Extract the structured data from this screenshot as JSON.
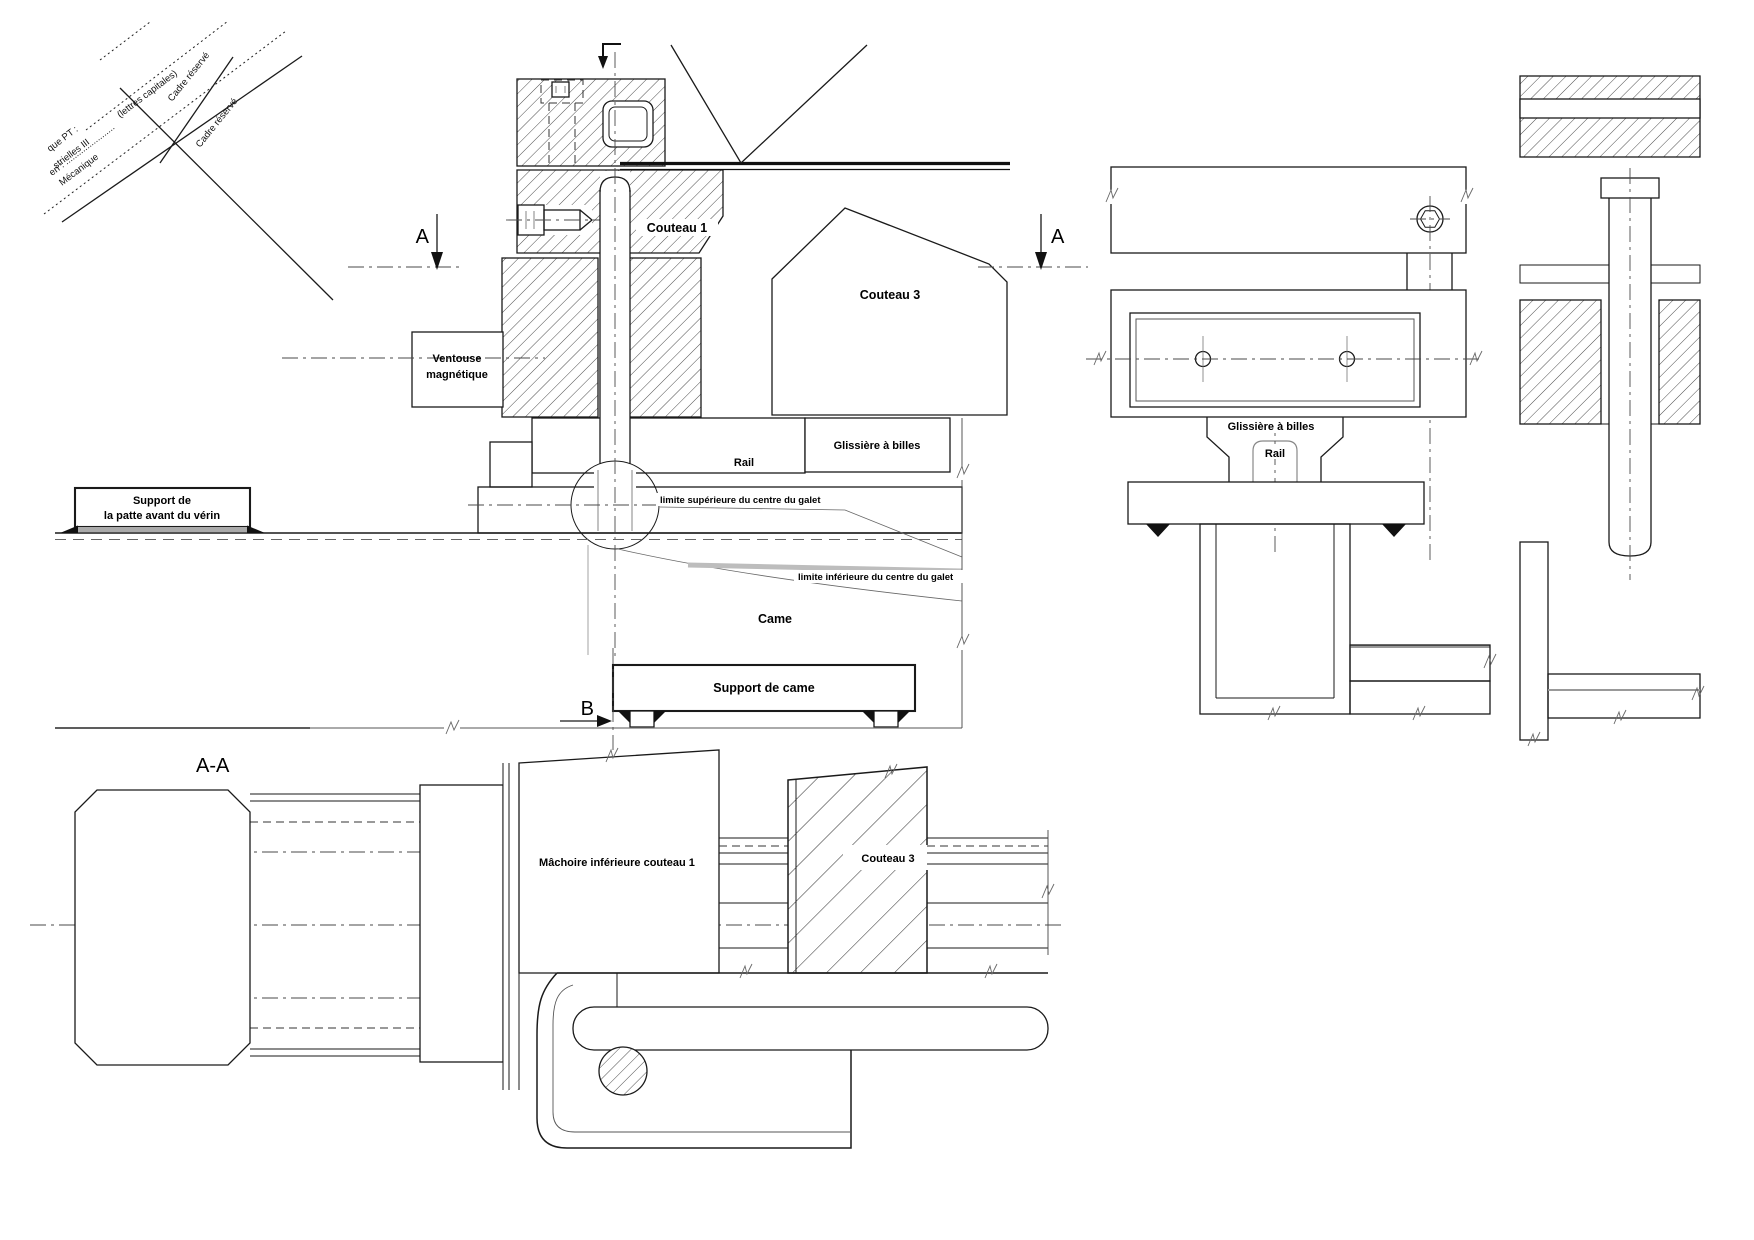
{
  "drawing_title": "Coupe mécanique - outil de découpe (couteaux, came, glissières)",
  "colors": {
    "line": "#1a1a1a",
    "auxiliary": "#999999",
    "cam_band": "#bdbdbd",
    "background": "#ffffff"
  },
  "corner": {
    "capitales": "(lettres capitales)",
    "en_line": "en : .......................",
    "frag1": "que PT :",
    "frag2": "strielles III",
    "frag3": "Mécanique",
    "cadre1": "Cadre réservé",
    "cadre2": "Cadre réservé"
  },
  "marks": {
    "a_left": "A",
    "a_right": "A",
    "b": "B",
    "aa": "A-A"
  },
  "upper": {
    "couteau1": "Couteau 1",
    "couteau3": "Couteau 3",
    "ventouse1": "Ventouse",
    "ventouse2": "magnétique",
    "glissiere": "Glissière à billes",
    "rail": "Rail",
    "support_patte1": "Support de",
    "support_patte2": "la patte avant du vérin",
    "limite_sup": "limite supérieure du centre du galet",
    "limite_inf": "limite inférieure du centre du galet",
    "came": "Came",
    "support_came": "Support de came"
  },
  "right": {
    "glissiere": "Glissière à billes",
    "rail": "Rail"
  },
  "bottom": {
    "machoire": "Mâchoire inférieure couteau 1",
    "couteau3": "Couteau 3"
  }
}
